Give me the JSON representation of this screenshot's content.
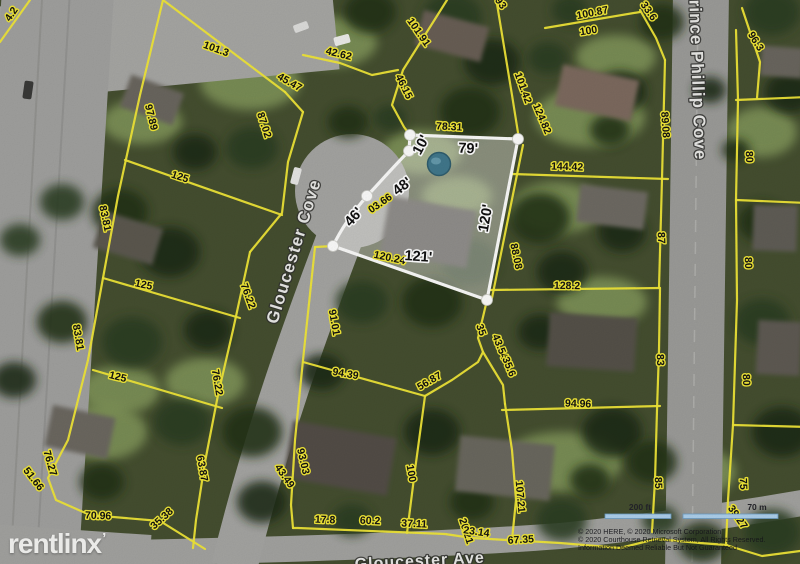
{
  "map": {
    "street_labels": [
      {
        "text": "Gloucester Cove",
        "x": 299,
        "y": 253,
        "rot": -73,
        "size": 17
      },
      {
        "text": "Prince Phillip Cove",
        "x": 692,
        "y": 74,
        "rot": 88,
        "size": 17
      },
      {
        "text": "Gloucester Ave",
        "x": 420,
        "y": 566,
        "rot": -3,
        "size": 16
      }
    ],
    "parcel_labels": [
      {
        "text": "4.2",
        "x": 14,
        "y": 16,
        "rot": -55
      },
      {
        "text": "101.3",
        "x": 215,
        "y": 52,
        "rot": 20
      },
      {
        "text": "42.62",
        "x": 338,
        "y": 57,
        "rot": 14
      },
      {
        "text": "45.47",
        "x": 288,
        "y": 85,
        "rot": 30
      },
      {
        "text": "46.15",
        "x": 401,
        "y": 88,
        "rot": 64
      },
      {
        "text": "101.91",
        "x": 416,
        "y": 34,
        "rot": 55
      },
      {
        "text": "97.89",
        "x": 148,
        "y": 118,
        "rot": 76
      },
      {
        "text": "87.02",
        "x": 261,
        "y": 126,
        "rot": 72
      },
      {
        "text": "125",
        "x": 179,
        "y": 180,
        "rot": 18
      },
      {
        "text": "83.81",
        "x": 102,
        "y": 219,
        "rot": 78
      },
      {
        "text": "125",
        "x": 143,
        "y": 288,
        "rot": 12
      },
      {
        "text": "83.81",
        "x": 75,
        "y": 338,
        "rot": 80
      },
      {
        "text": "125",
        "x": 117,
        "y": 380,
        "rot": 14
      },
      {
        "text": "76.27",
        "x": 47,
        "y": 464,
        "rot": 74
      },
      {
        "text": "51.66",
        "x": 31,
        "y": 481,
        "rot": 52
      },
      {
        "text": "70.96",
        "x": 98,
        "y": 519,
        "rot": 2
      },
      {
        "text": "35.38",
        "x": 164,
        "y": 521,
        "rot": -42
      },
      {
        "text": "63.87",
        "x": 199,
        "y": 469,
        "rot": 80
      },
      {
        "text": "76.22",
        "x": 214,
        "y": 383,
        "rot": 80
      },
      {
        "text": "76.22",
        "x": 245,
        "y": 297,
        "rot": 70
      },
      {
        "text": "91.01",
        "x": 331,
        "y": 323,
        "rot": 80
      },
      {
        "text": "94.39",
        "x": 345,
        "y": 377,
        "rot": 10
      },
      {
        "text": "93.03",
        "x": 300,
        "y": 462,
        "rot": 77
      },
      {
        "text": "43.49",
        "x": 282,
        "y": 478,
        "rot": 55
      },
      {
        "text": "100",
        "x": 408,
        "y": 474,
        "rot": 80
      },
      {
        "text": "17.8",
        "x": 325,
        "y": 523,
        "rot": 2
      },
      {
        "text": "60.2",
        "x": 370,
        "y": 524,
        "rot": 2
      },
      {
        "text": "37.11",
        "x": 414,
        "y": 527,
        "rot": 3
      },
      {
        "text": "20.21",
        "x": 463,
        "y": 532,
        "rot": 72
      },
      {
        "text": "23.14",
        "x": 476,
        "y": 535,
        "rot": 8
      },
      {
        "text": "107.21",
        "x": 517,
        "y": 497,
        "rot": 85
      },
      {
        "text": "56.87",
        "x": 431,
        "y": 384,
        "rot": -30
      },
      {
        "text": "35",
        "x": 478,
        "y": 331,
        "rot": 70
      },
      {
        "text": "43.54",
        "x": 497,
        "y": 348,
        "rot": 68
      },
      {
        "text": "35.6",
        "x": 506,
        "y": 368,
        "rot": 68
      },
      {
        "text": "94.96",
        "x": 578,
        "y": 407,
        "rot": 2
      },
      {
        "text": "128.2",
        "x": 567,
        "y": 289,
        "rot": 1
      },
      {
        "text": "83",
        "x": 657,
        "y": 360,
        "rot": 88
      },
      {
        "text": "85",
        "x": 655,
        "y": 483,
        "rot": 88
      },
      {
        "text": "88.08",
        "x": 513,
        "y": 257,
        "rot": 78
      },
      {
        "text": "120.24",
        "x": 389,
        "y": 261,
        "rot": 12
      },
      {
        "text": "03.66",
        "x": 382,
        "y": 206,
        "rot": -35
      },
      {
        "text": "78.31",
        "x": 449,
        "y": 130,
        "rot": 3
      },
      {
        "text": "101.42",
        "x": 520,
        "y": 89,
        "rot": 70
      },
      {
        "text": "124.82",
        "x": 539,
        "y": 120,
        "rot": 67
      },
      {
        "text": "144.42",
        "x": 567,
        "y": 170,
        "rot": 2
      },
      {
        "text": "87",
        "x": 658,
        "y": 238,
        "rot": 88
      },
      {
        "text": "89.08",
        "x": 662,
        "y": 125,
        "rot": 86
      },
      {
        "text": "100.87",
        "x": 593,
        "y": 16,
        "rot": -11
      },
      {
        "text": "100",
        "x": 589,
        "y": 34,
        "rot": -9
      },
      {
        "text": "33.6",
        "x": 646,
        "y": 13,
        "rot": 55
      },
      {
        "text": "96.3",
        "x": 753,
        "y": 43,
        "rot": 58
      },
      {
        "text": "93",
        "x": 498,
        "y": 5,
        "rot": 55
      },
      {
        "text": "80",
        "x": 746,
        "y": 157,
        "rot": 88
      },
      {
        "text": "80",
        "x": 745,
        "y": 263,
        "rot": 88
      },
      {
        "text": "80",
        "x": 743,
        "y": 380,
        "rot": 88
      },
      {
        "text": "75",
        "x": 740,
        "y": 484,
        "rot": 88
      },
      {
        "text": "39.27",
        "x": 735,
        "y": 519,
        "rot": 55
      },
      {
        "text": "67.35",
        "x": 521,
        "y": 543,
        "rot": -3
      }
    ],
    "subject_labels": [
      {
        "text": "10'",
        "x": 425,
        "y": 147,
        "rot": -62
      },
      {
        "text": "79'",
        "x": 468,
        "y": 153,
        "rot": 2
      },
      {
        "text": "48'",
        "x": 405,
        "y": 190,
        "rot": -38
      },
      {
        "text": "46'",
        "x": 357,
        "y": 220,
        "rot": -48
      },
      {
        "text": "120'",
        "x": 490,
        "y": 219,
        "rot": -80
      },
      {
        "text": "121'",
        "x": 418,
        "y": 261,
        "rot": 4
      }
    ]
  },
  "watermark": {
    "text": "rentlinx",
    "tick": "’"
  },
  "scale_bar": {
    "left_label": "200 ft",
    "right_label": "70 m"
  },
  "attribution": {
    "line1": "© 2020 HERE, © 2020 Microsoft Corporation",
    "line2": "© 2020 Courthouse Retrieval System, All Rights Reserved.",
    "line3": "Information Deemed Reliable But Not Guaranteed"
  },
  "colors": {
    "parcel_line": "#f1e738",
    "subject_outline": "#fbfbfa",
    "pool": "#41788c",
    "scale_bar_fill": "#aed0ec",
    "road": "#a3a3a0"
  }
}
